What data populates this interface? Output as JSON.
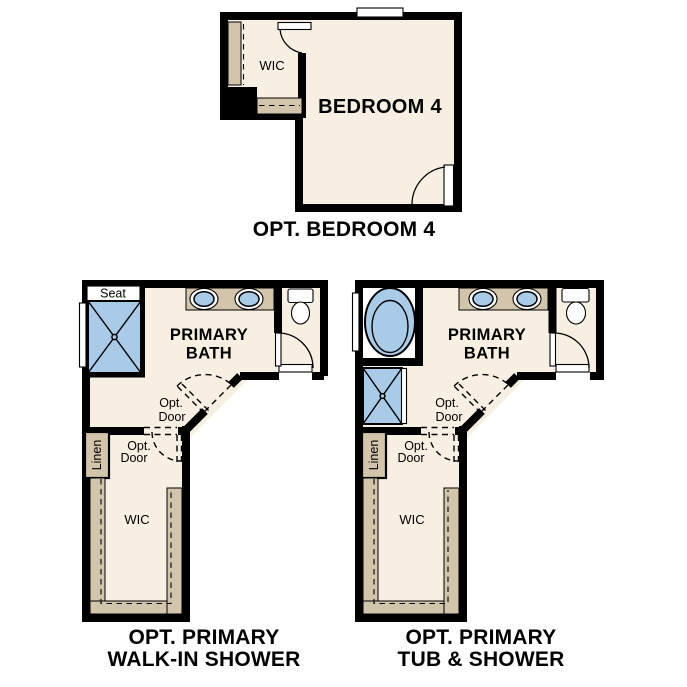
{
  "colors": {
    "wall": "#000000",
    "floor": "#F7EFE2",
    "cabinet": "#D2C5AC",
    "fixture": "#A9CBE8",
    "glass": "#FFFFFF",
    "label": "#000000"
  },
  "plans": {
    "bedroom4": {
      "caption": "OPT. BEDROOM 4",
      "room_label": "BEDROOM 4",
      "wic_label": "WIC"
    },
    "walkin_shower": {
      "caption_line1": "OPT. PRIMARY",
      "caption_line2": "WALK-IN SHOWER",
      "room_line1": "PRIMARY",
      "room_line2": "BATH",
      "seat_label": "Seat",
      "linen_label": "Linen",
      "wic_label": "WIC",
      "opt_door_line1": "Opt.",
      "opt_door_line2": "Door"
    },
    "tub_shower": {
      "caption_line1": "OPT. PRIMARY",
      "caption_line2": "TUB & SHOWER",
      "room_line1": "PRIMARY",
      "room_line2": "BATH",
      "linen_label": "Linen",
      "wic_label": "WIC",
      "opt_door_line1": "Opt.",
      "opt_door_line2": "Door"
    }
  }
}
